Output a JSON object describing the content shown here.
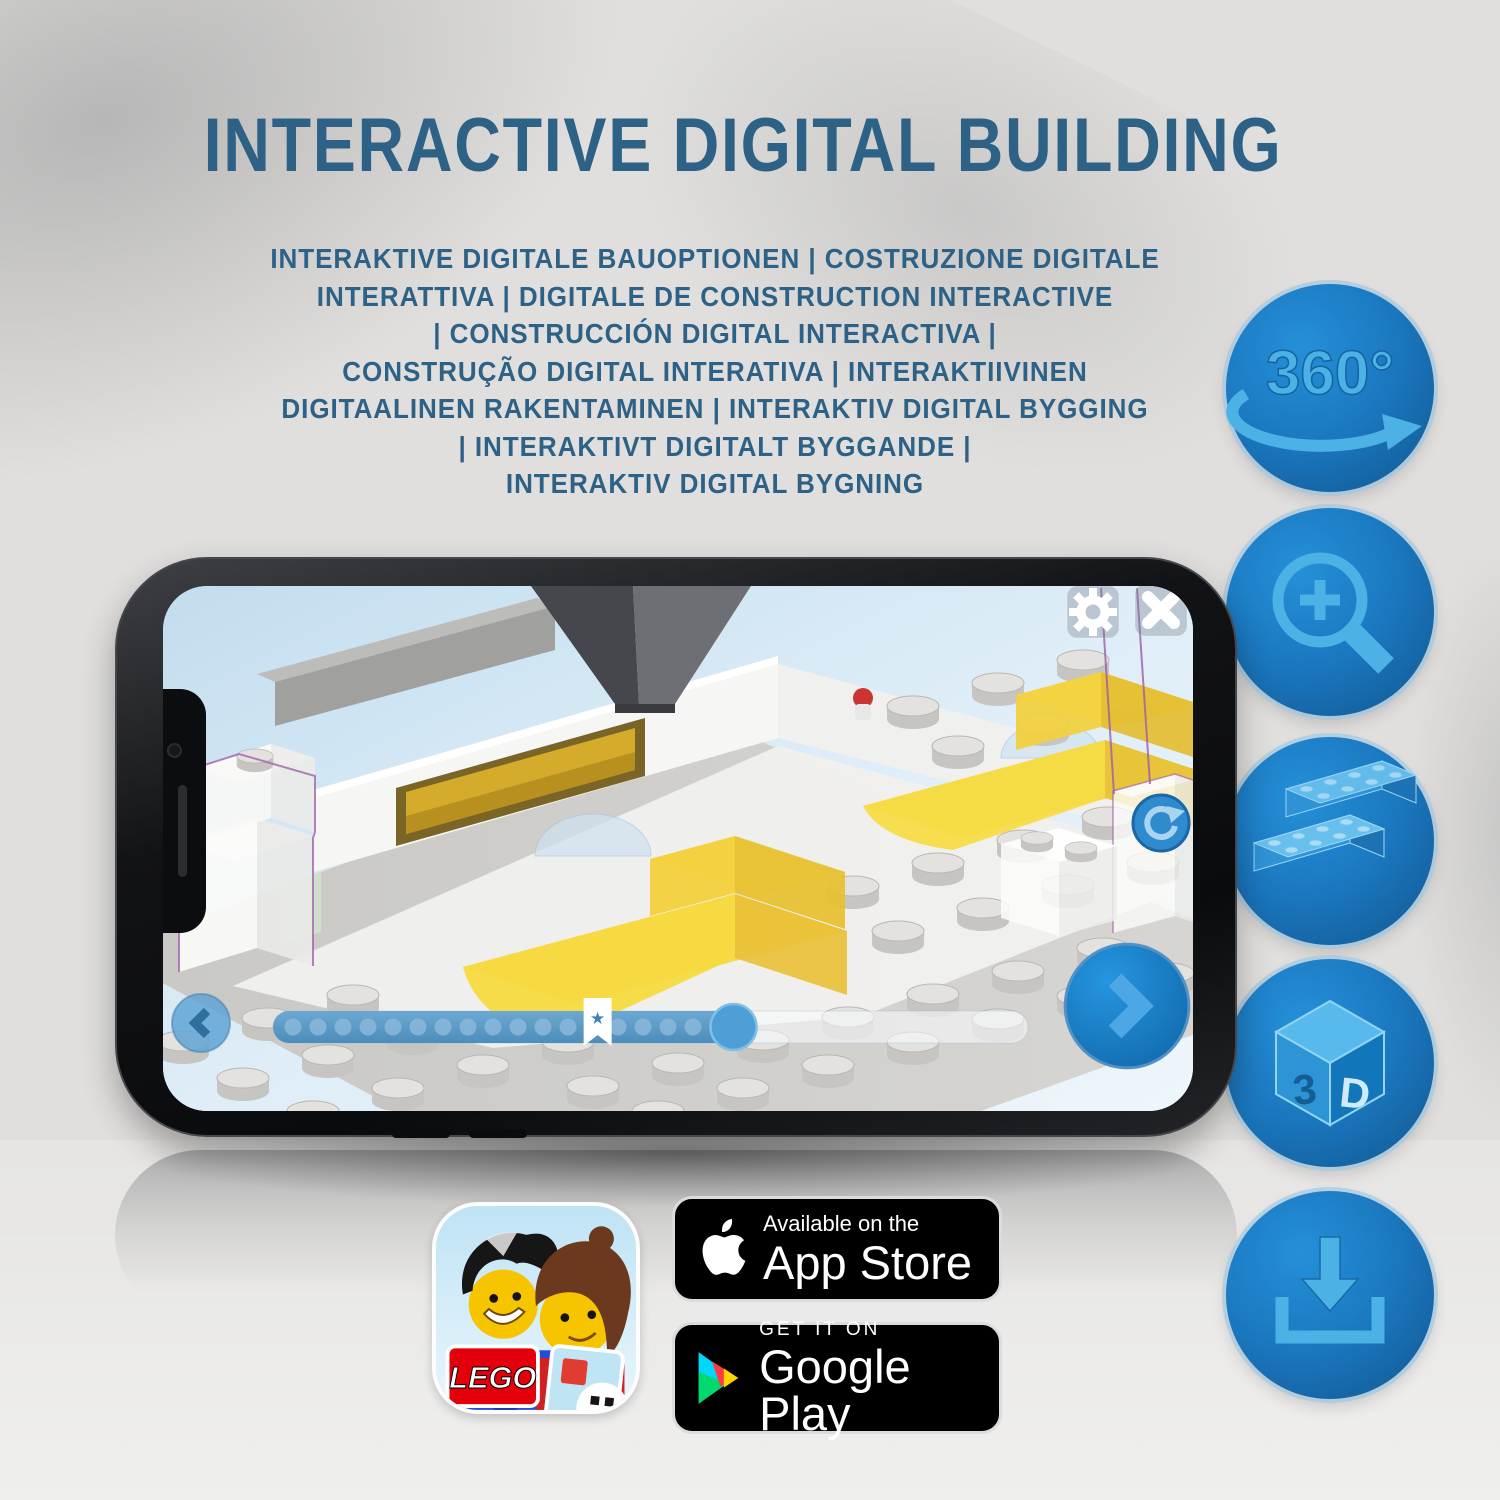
{
  "header": {
    "title": "INTERACTIVE DIGITAL BUILDING"
  },
  "subtitle": {
    "lines": [
      "INTERAKTIVE DIGITALE BAUOPTIONEN | COSTRUZIONE DIGITALE",
      "INTERATTIVA | DIGITALE DE CONSTRUCTION INTERACTIVE",
      "| CONSTRUCCIÓN DIGITAL INTERACTIVA |",
      "CONSTRUÇÃO DIGITAL INTERATIVA | INTERAKTIIVINEN",
      "DIGITAALINEN RAKENTAMINEN | INTERAKTIV DIGITAL BYGGING",
      "| INTERAKTIVT DIGITALT BYGGANDE |",
      "INTERAKTIV DIGITAL BYGNING"
    ]
  },
  "features": [
    {
      "name": "360-rotation",
      "label": "360°"
    },
    {
      "name": "zoom-magnifier"
    },
    {
      "name": "digital-bricks"
    },
    {
      "name": "3d-view",
      "front_label": "3",
      "side_label": "D"
    },
    {
      "name": "download"
    }
  ],
  "phone": {
    "screen": {
      "progress": {
        "dot_count": 18,
        "fill_percent": 61,
        "bookmark_percent": 43
      },
      "icons": {
        "star": "★"
      }
    }
  },
  "store_badges": {
    "app_store": {
      "tagline": "Available on the",
      "store_name": "App Store"
    },
    "google_play": {
      "tagline": "GET IT ON",
      "store_name": "Google Play"
    }
  },
  "app_icon": {
    "logo_text": "LEGO"
  },
  "colors": {
    "title_blue": "#2d6286",
    "circle_blue": "#1b78c0",
    "glyph_blue": "#4cb2e6",
    "bar_blue": "#4a90c4",
    "bed_yellow": "#f2d84c"
  }
}
